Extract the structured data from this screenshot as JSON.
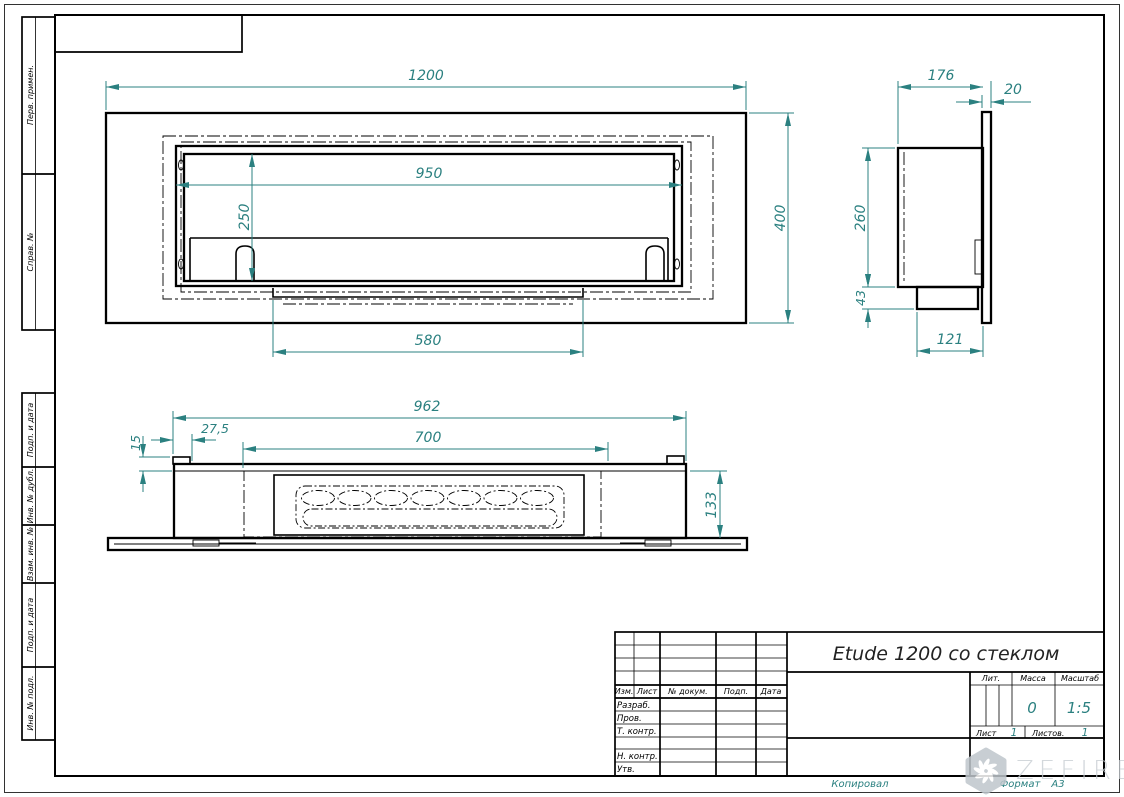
{
  "dims": {
    "front": {
      "width": "1200",
      "opening_width": "950",
      "opening_height": "250",
      "base_width": "580",
      "height": "400"
    },
    "side": {
      "depth": "176",
      "glass_thickness": "20",
      "body_height": "260",
      "base_height": "43",
      "base_depth": "121"
    },
    "plan": {
      "width": "962",
      "burner_width": "700",
      "offset": "27,5",
      "tab_height": "15",
      "depth": "133"
    }
  },
  "title_block": {
    "title": "Etude 1200 со стеклом",
    "columns": [
      "Изм.",
      "Лист",
      "№ докум.",
      "Подп.",
      "Дата"
    ],
    "roles": [
      "Разраб.",
      "Пров.",
      "Т. контр.",
      "Н. контр.",
      "Утв."
    ],
    "lit_label": "Лит.",
    "mass_label": "Масса",
    "mass_value": "0",
    "scale_label": "Масштаб",
    "scale_value": "1:5",
    "sheet_label": "Лист",
    "sheet_value": "1",
    "sheets_label": "Листов.",
    "sheets_value": "1"
  },
  "sidebar": {
    "labels": [
      "Перв. примен.",
      "Справ. №",
      "Подп. и дата",
      "Инв. № дубл.",
      "Взам. инв. №",
      "Подп. и дата",
      "Инв. № подл."
    ]
  },
  "footer": {
    "copied": "Копировал",
    "format_label": "Формат",
    "format_value": "А3"
  },
  "watermark": {
    "text": "ZEFIRE"
  },
  "colors": {
    "drawing_line": "#000000",
    "dimension": "#2b8080",
    "watermark": "#c6ccd2"
  }
}
